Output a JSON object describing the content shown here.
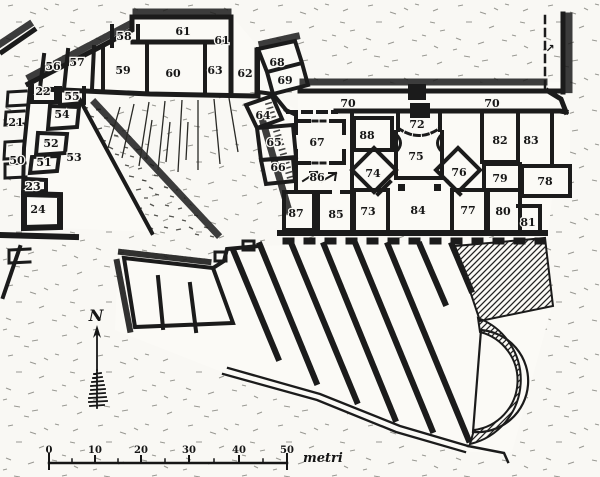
{
  "figure": {
    "type": "archaeological-site-plan",
    "description": "Hand-drawn excavation plan with numbered rooms, terraced slope hatching, a diagonal striped structure with apse, north arrow and metric scale bar",
    "ink_color": "#1b1b1b",
    "paper_color": "#f9f8f4"
  },
  "room_labels": [
    {
      "label": "21",
      "x": 16,
      "y": 122
    },
    {
      "label": "22",
      "x": 43,
      "y": 91
    },
    {
      "label": "23",
      "x": 33,
      "y": 186
    },
    {
      "label": "24",
      "x": 38,
      "y": 209
    },
    {
      "label": "50",
      "x": 17,
      "y": 160
    },
    {
      "label": "51",
      "x": 44,
      "y": 162
    },
    {
      "label": "52",
      "x": 51,
      "y": 143
    },
    {
      "label": "53",
      "x": 74,
      "y": 157
    },
    {
      "label": "54",
      "x": 62,
      "y": 114
    },
    {
      "label": "55",
      "x": 72,
      "y": 96
    },
    {
      "label": "56",
      "x": 53,
      "y": 66
    },
    {
      "label": "57",
      "x": 77,
      "y": 62
    },
    {
      "label": "58",
      "x": 124,
      "y": 36
    },
    {
      "label": "59",
      "x": 123,
      "y": 70
    },
    {
      "label": "60",
      "x": 173,
      "y": 73
    },
    {
      "label": "61",
      "x": 183,
      "y": 31
    },
    {
      "label": "61",
      "x": 222,
      "y": 40
    },
    {
      "label": "62",
      "x": 245,
      "y": 73
    },
    {
      "label": "63",
      "x": 215,
      "y": 70
    },
    {
      "label": "64",
      "x": 263,
      "y": 115
    },
    {
      "label": "65",
      "x": 274,
      "y": 142
    },
    {
      "label": "66",
      "x": 278,
      "y": 167
    },
    {
      "label": "67",
      "x": 317,
      "y": 142
    },
    {
      "label": "68",
      "x": 277,
      "y": 62
    },
    {
      "label": "69",
      "x": 285,
      "y": 80
    },
    {
      "label": "70",
      "x": 348,
      "y": 103
    },
    {
      "label": "70",
      "x": 492,
      "y": 103
    },
    {
      "label": "72",
      "x": 417,
      "y": 124
    },
    {
      "label": "73",
      "x": 368,
      "y": 211
    },
    {
      "label": "74",
      "x": 373,
      "y": 173
    },
    {
      "label": "75",
      "x": 416,
      "y": 156
    },
    {
      "label": "76",
      "x": 459,
      "y": 172
    },
    {
      "label": "77",
      "x": 468,
      "y": 210
    },
    {
      "label": "78",
      "x": 545,
      "y": 181
    },
    {
      "label": "79",
      "x": 500,
      "y": 178
    },
    {
      "label": "80",
      "x": 503,
      "y": 211
    },
    {
      "label": "81",
      "x": 528,
      "y": 222
    },
    {
      "label": "82",
      "x": 500,
      "y": 140
    },
    {
      "label": "83",
      "x": 531,
      "y": 140
    },
    {
      "label": "84",
      "x": 418,
      "y": 210
    },
    {
      "label": "85",
      "x": 336,
      "y": 214
    },
    {
      "label": "86",
      "x": 317,
      "y": 177
    },
    {
      "label": "87",
      "x": 296,
      "y": 213
    },
    {
      "label": "88",
      "x": 367,
      "y": 135
    }
  ],
  "north_indicator": {
    "label": "N",
    "x": 96,
    "y": 321
  },
  "icons": {
    "passage_arrow": "↗"
  },
  "scale_bar": {
    "tick_labels": [
      {
        "label": "0",
        "x": 49
      },
      {
        "label": "10",
        "x": 95
      },
      {
        "label": "20",
        "x": 141
      },
      {
        "label": "30",
        "x": 189
      },
      {
        "label": "40",
        "x": 239
      },
      {
        "label": "50",
        "x": 287
      }
    ],
    "unit": "metri",
    "bar_y": 463,
    "label_y": 453,
    "x_start": 49,
    "x_end": 287
  }
}
